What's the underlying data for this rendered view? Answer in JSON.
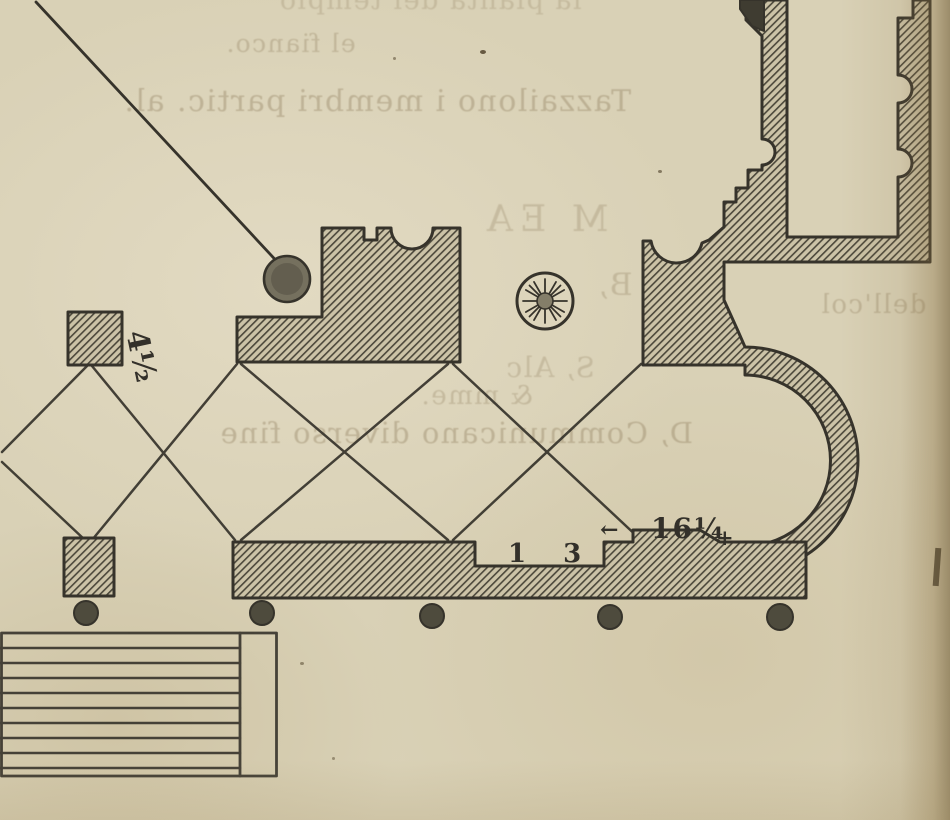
{
  "bleedthrough": {
    "top_cut_line": "la pianta del tempio",
    "line_fianco": "el fianco.",
    "line_main": "Tazzailono i membri partic. al.",
    "legend_heading": "M EA",
    "legend_b": "B,",
    "legend_c": "S, Alc",
    "fragment_col": "dell'col",
    "legend_amp": "& mme.",
    "legend_d": "D, Communicano diverso fine"
  },
  "plan_labels": {
    "dim_small_pier": "4½",
    "dim_recess": "1 3",
    "dim_apse": "16¼",
    "arrow_left": "←",
    "plus_mark": "+"
  },
  "colors": {
    "paper": "#d9d1b6",
    "ink": "#36332b",
    "hatch_fill": "#ccc3a7",
    "hatch_line": "#4b473a",
    "bleed_text": "#8e7c5c"
  }
}
